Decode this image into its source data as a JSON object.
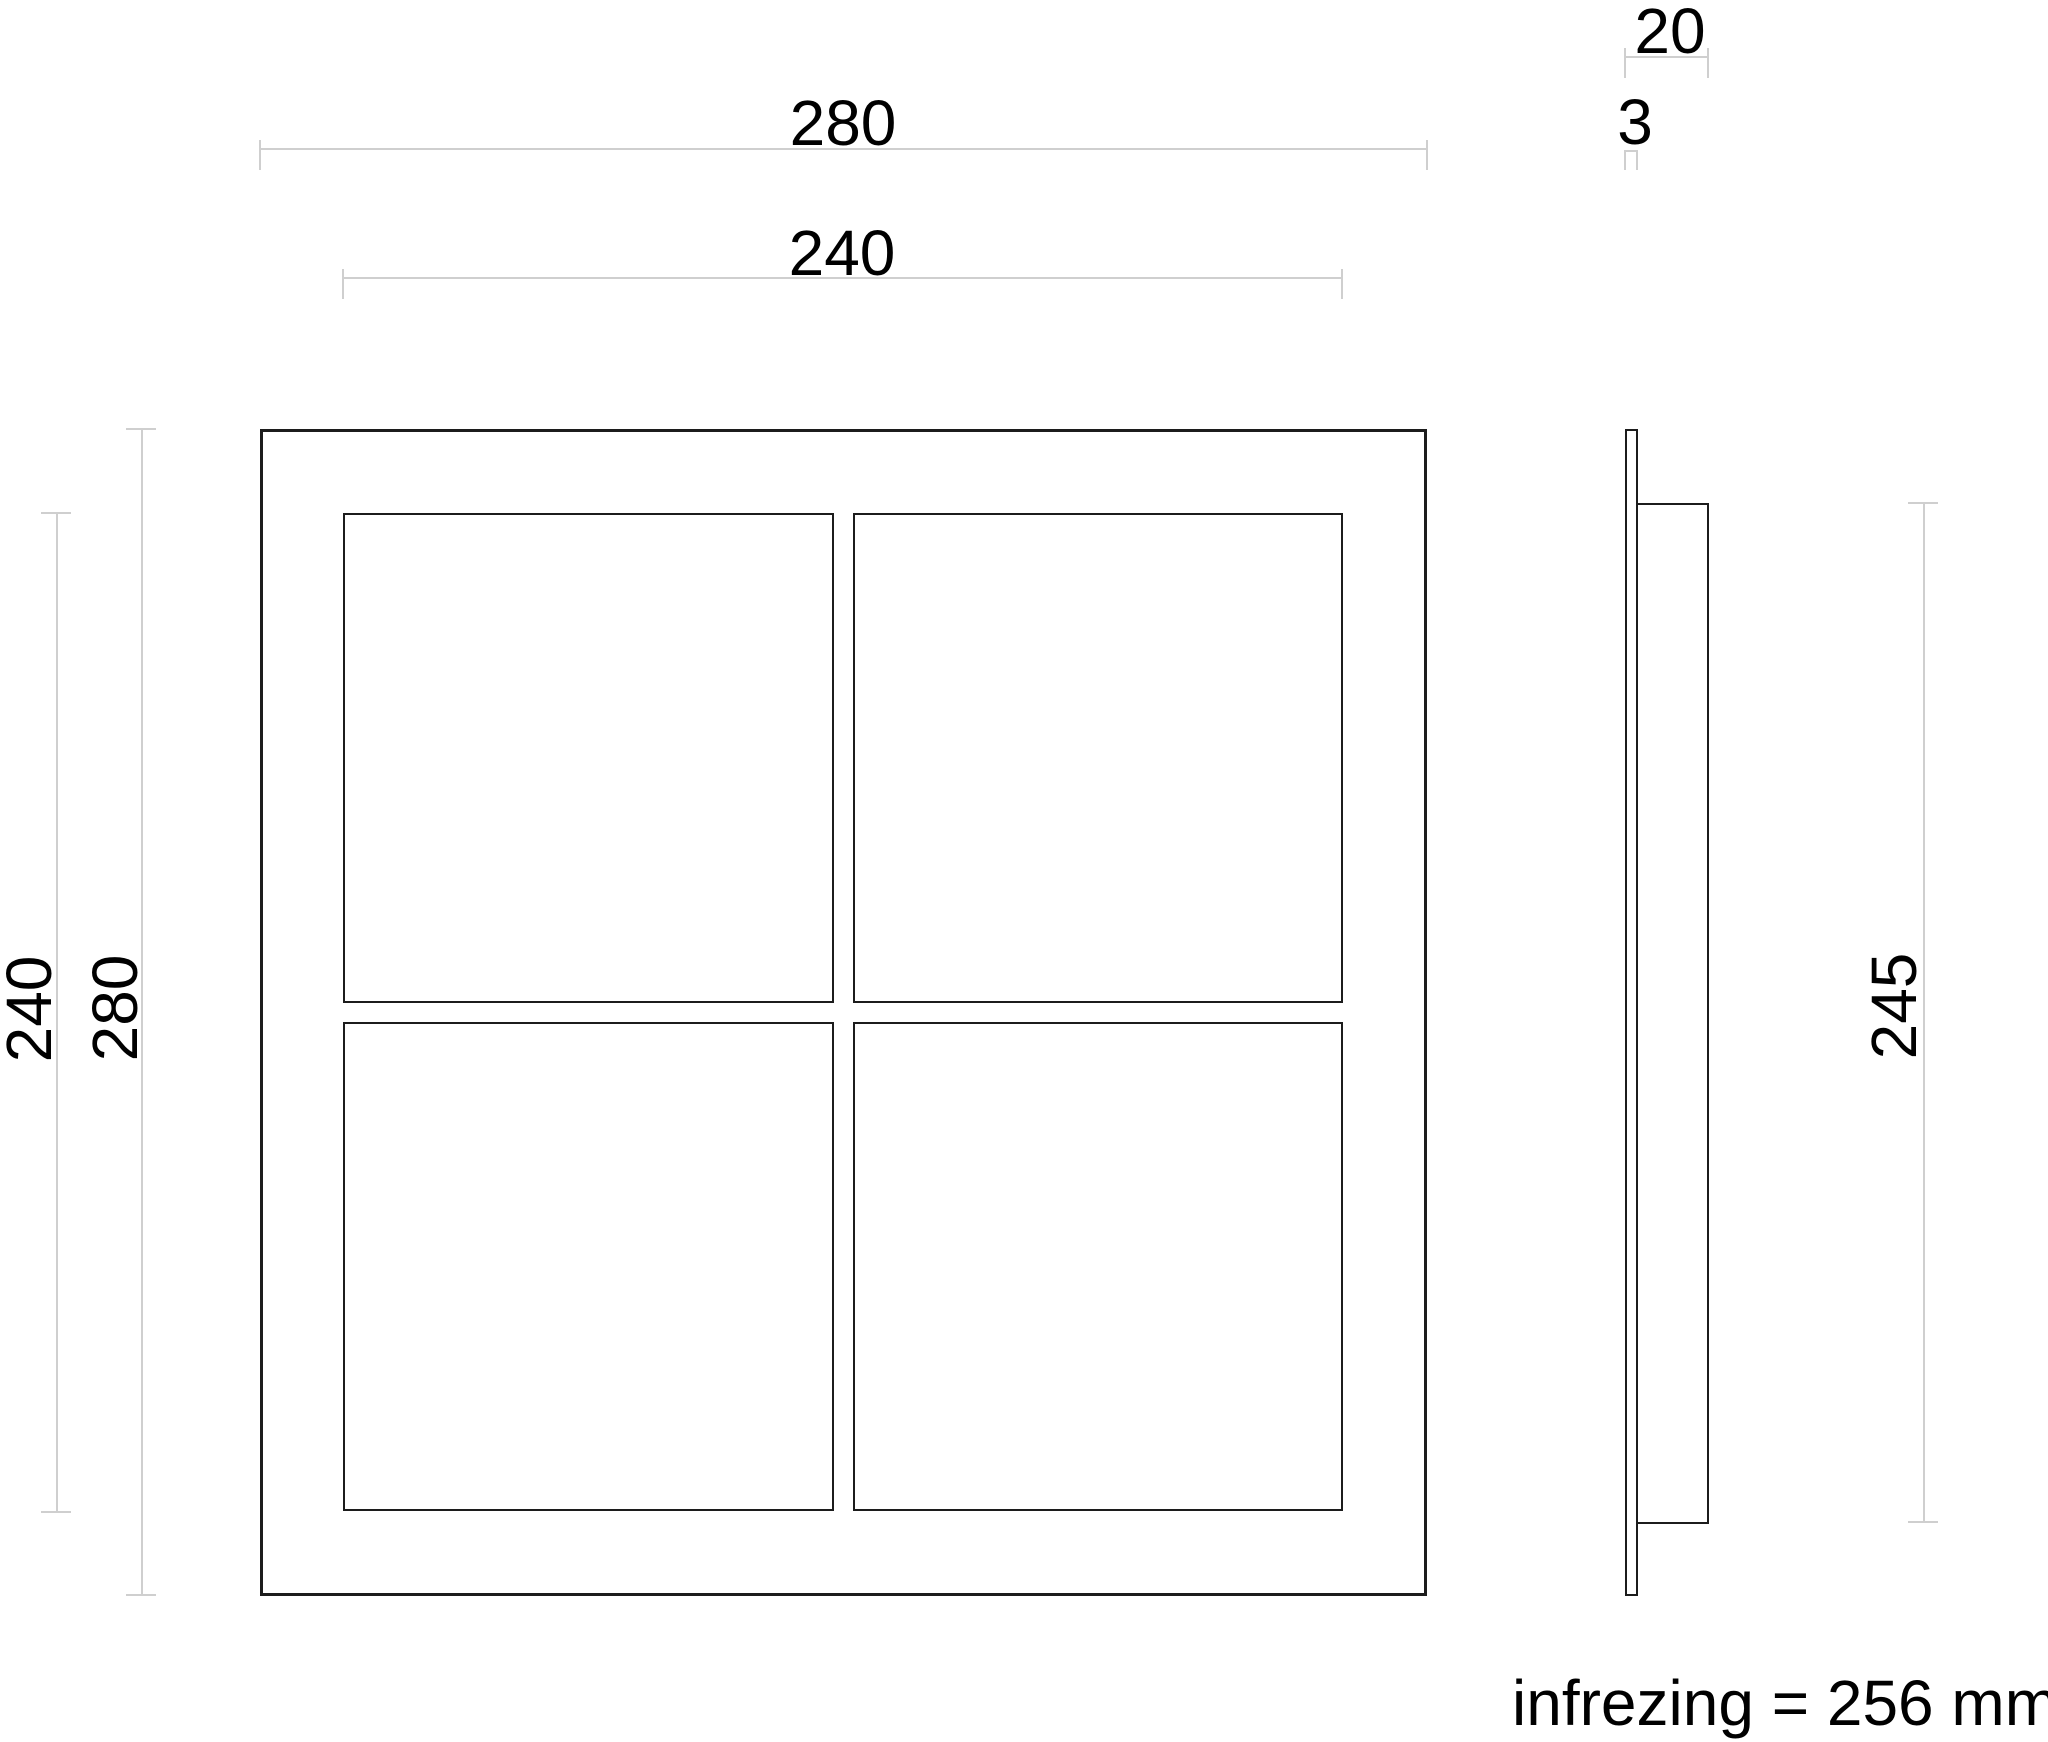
{
  "drawing": {
    "front_view": {
      "outer_width": "280",
      "inner_width": "240",
      "inner_height": "240",
      "outer_height": "280"
    },
    "side_view": {
      "depth": "20",
      "plate_thickness": "3",
      "recess_height": "245"
    },
    "note": "infrezing = 256 mm",
    "colors": {
      "drawing_line": "#1c1c1c",
      "dimension_line": "#cfcfcf",
      "text": "#000000",
      "background": "#ffffff"
    }
  }
}
